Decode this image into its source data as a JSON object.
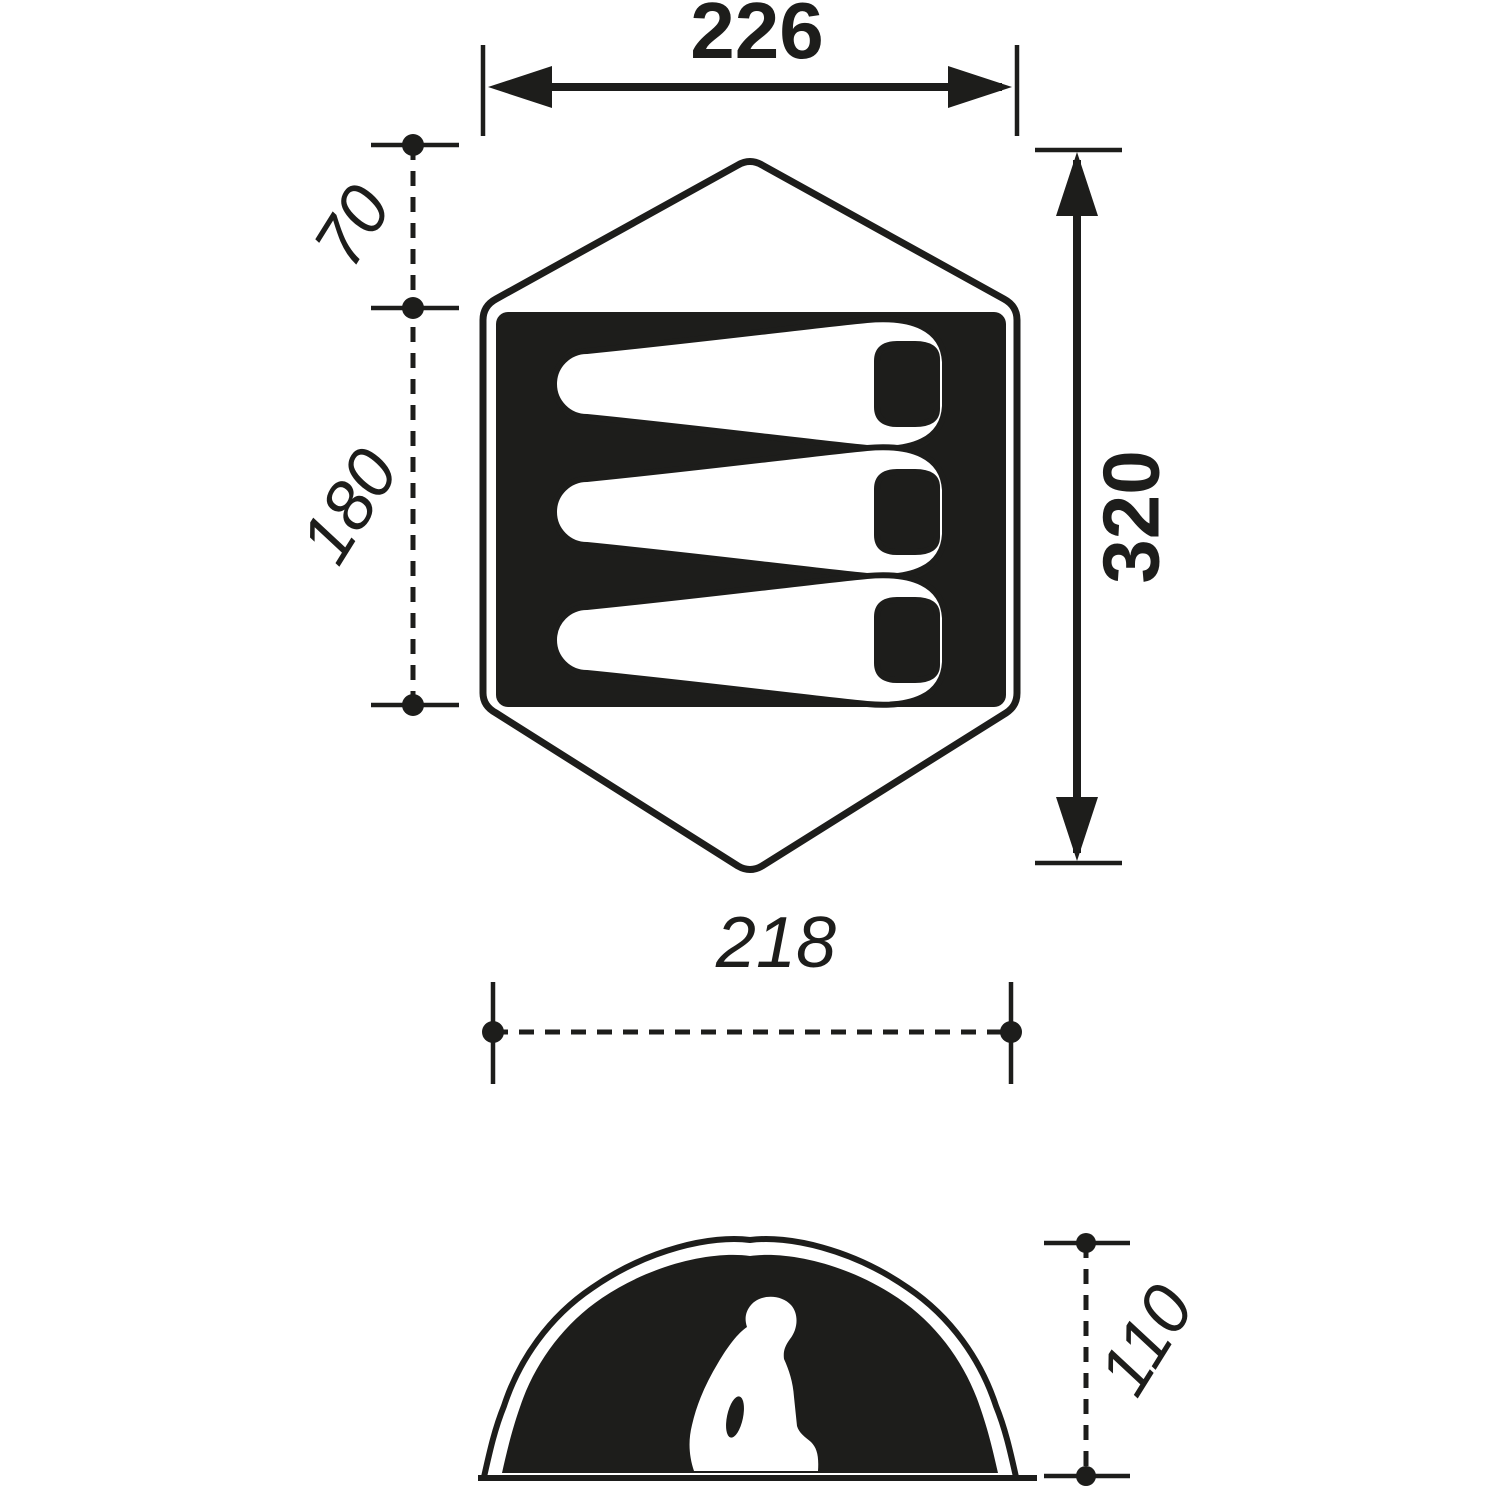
{
  "colors": {
    "ink": "#1d1d1b",
    "paper": "#ffffff"
  },
  "floor_plan": {
    "outer_width": "226",
    "porch_depth": "70",
    "inner_depth": "180",
    "total_length": "320",
    "inner_width": "218",
    "sleeping_pad_count": 3
  },
  "elevation": {
    "interior_height": "110"
  }
}
